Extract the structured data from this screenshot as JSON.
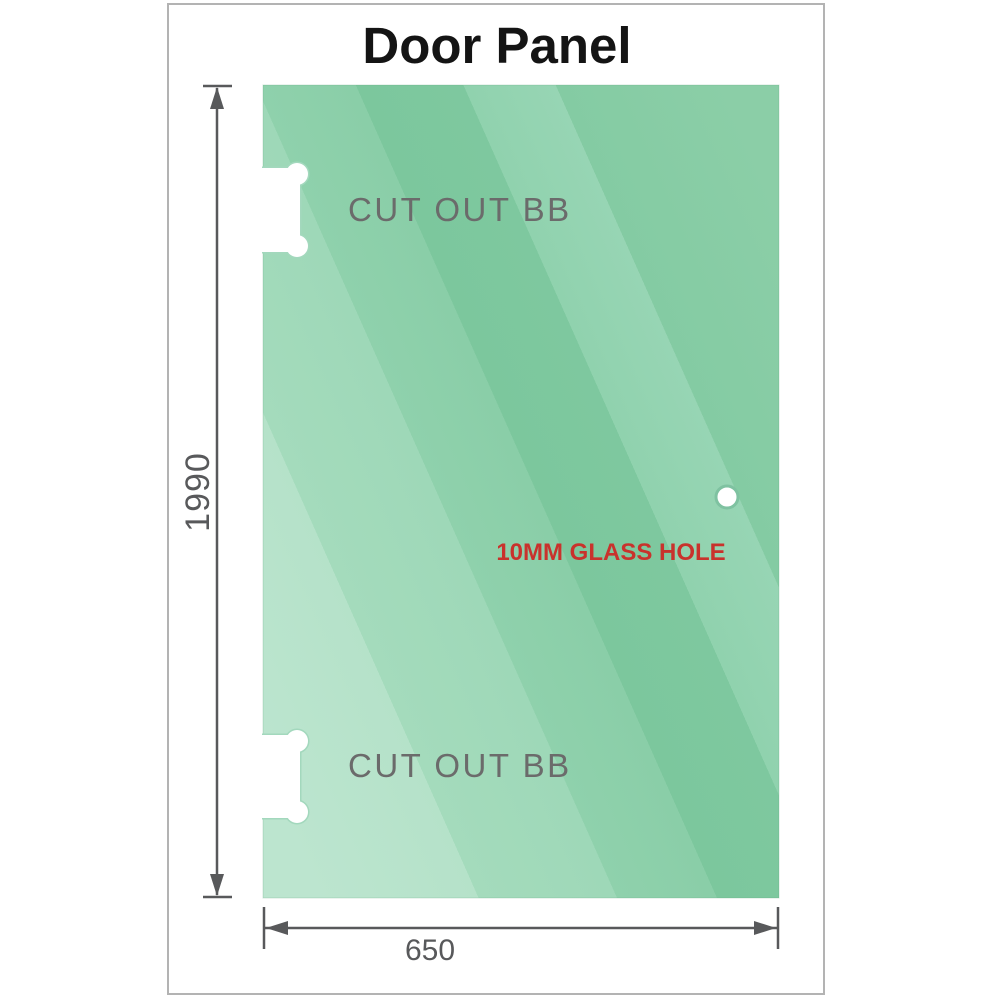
{
  "title": "Door Panel",
  "panel": {
    "cutouts": [
      {
        "label": "CUT OUT BB"
      },
      {
        "label": "CUT OUT BB"
      }
    ],
    "hole_label": "10MM GLASS HOLE"
  },
  "dimensions": {
    "height": "1990",
    "width": "650"
  },
  "colors": {
    "glass_light": "#b7e3cb",
    "glass_dark": "#7cc79d",
    "dimension": "#58595b",
    "cutout_label": "#6b6b6b",
    "hole_label": "#c9322c",
    "title": "#141414",
    "frame_border": "#b3b3b3"
  }
}
